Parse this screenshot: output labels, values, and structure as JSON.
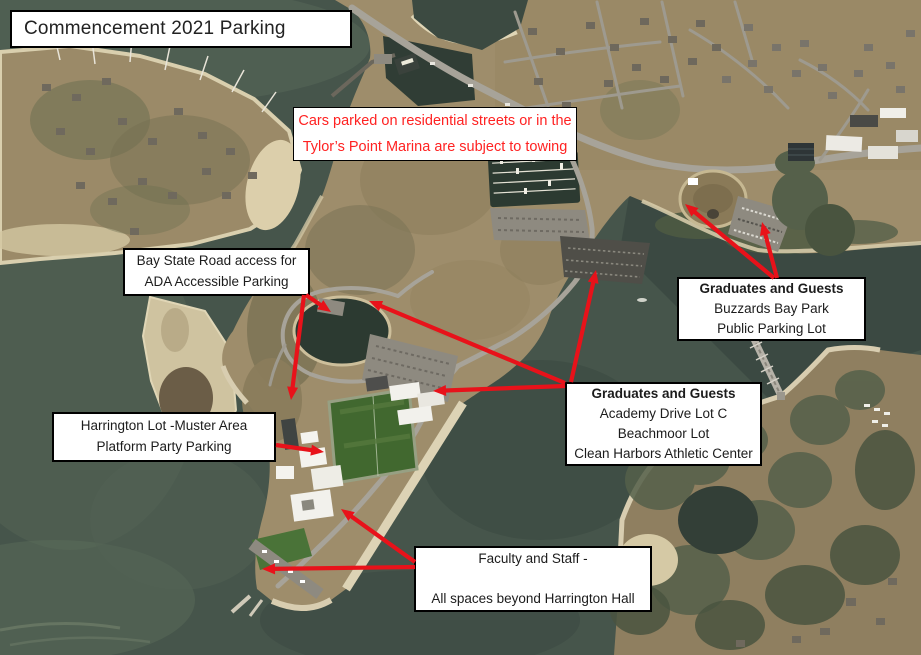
{
  "title": {
    "text": "Commencement 2021 Parking"
  },
  "colors": {
    "arrow_red": "#e8121a",
    "warning_red": "#ff2222",
    "box_bg": "#ffffff",
    "box_border": "#000000"
  },
  "warning": {
    "name": "towing-warning",
    "x": 293,
    "y": 107,
    "w": 284,
    "h": 54,
    "lines": [
      {
        "text": "Cars parked on residential streets or in the",
        "bold": false
      },
      {
        "text": "Tylor’s Point Marina are subject to towing",
        "bold": false
      }
    ]
  },
  "labels": [
    {
      "name": "bay-state-road",
      "x": 123,
      "y": 248,
      "w": 187,
      "h": 48,
      "lines": [
        {
          "text": "Bay State Road access for",
          "bold": false
        },
        {
          "text": "ADA Accessible Parking",
          "bold": false
        }
      ]
    },
    {
      "name": "buzzards-bay-park",
      "x": 677,
      "y": 277,
      "w": 189,
      "h": 64,
      "lines": [
        {
          "text": "Graduates and Guests",
          "bold": true
        },
        {
          "text": "Buzzards Bay Park",
          "bold": false
        },
        {
          "text": "Public Parking Lot",
          "bold": false
        }
      ]
    },
    {
      "name": "academy-drive",
      "x": 565,
      "y": 382,
      "w": 197,
      "h": 84,
      "lines": [
        {
          "text": "Graduates and Guests",
          "bold": true
        },
        {
          "text": "Academy Drive Lot C",
          "bold": false
        },
        {
          "text": "Beachmoor Lot",
          "bold": false
        },
        {
          "text": "Clean Harbors Athletic Center",
          "bold": false
        }
      ]
    },
    {
      "name": "harrington-lot",
      "x": 52,
      "y": 412,
      "w": 224,
      "h": 50,
      "lines": [
        {
          "text": "Harrington Lot -Muster Area",
          "bold": false
        },
        {
          "text": "Platform Party Parking",
          "bold": false
        }
      ]
    },
    {
      "name": "faculty-staff",
      "x": 414,
      "y": 546,
      "w": 238,
      "h": 66,
      "lines": [
        {
          "text": "Faculty and Staff -",
          "bold": false
        },
        {
          "text": "",
          "bold": false
        },
        {
          "text": "All spaces beyond Harrington Hall",
          "bold": false
        }
      ]
    }
  ],
  "arrows": [
    {
      "from": "bay-state-road",
      "x1": 306,
      "y1": 295,
      "x2": 331,
      "y2": 312
    },
    {
      "from": "bay-state-road",
      "x1": 304,
      "y1": 295,
      "x2": 291,
      "y2": 400
    },
    {
      "from": "buzzards-bay-park",
      "x1": 774,
      "y1": 278,
      "x2": 685,
      "y2": 204
    },
    {
      "from": "buzzards-bay-park",
      "x1": 777,
      "y1": 278,
      "x2": 762,
      "y2": 222
    },
    {
      "from": "academy-drive",
      "x1": 565,
      "y1": 383,
      "x2": 369,
      "y2": 301
    },
    {
      "from": "academy-drive",
      "x1": 565,
      "y1": 386,
      "x2": 433,
      "y2": 391
    },
    {
      "from": "academy-drive",
      "x1": 571,
      "y1": 382,
      "x2": 596,
      "y2": 270
    },
    {
      "from": "harrington-lot",
      "x1": 276,
      "y1": 445,
      "x2": 324,
      "y2": 452
    },
    {
      "from": "faculty-staff",
      "x1": 415,
      "y1": 562,
      "x2": 341,
      "y2": 509
    },
    {
      "from": "faculty-staff",
      "x1": 415,
      "y1": 567,
      "x2": 262,
      "y2": 569
    }
  ]
}
